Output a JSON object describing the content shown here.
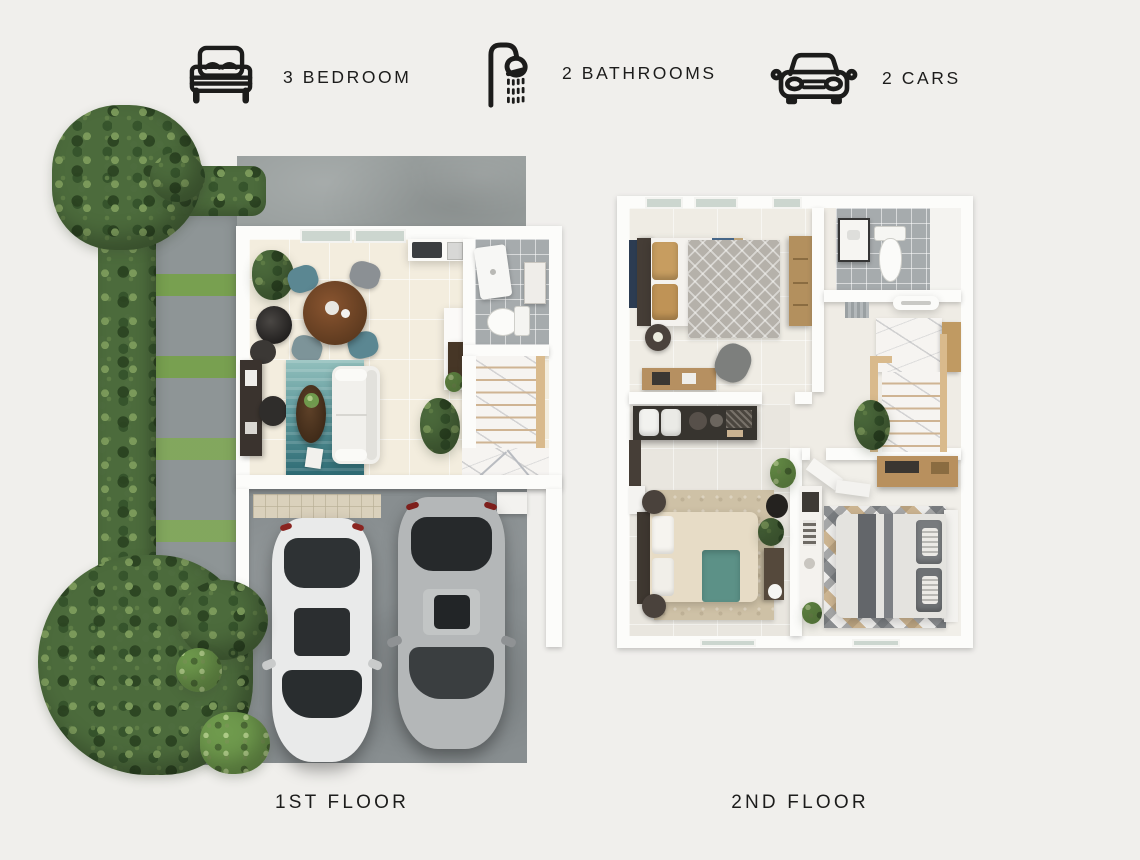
{
  "header": {
    "features": [
      {
        "icon": "bed-icon",
        "label": "3 BEDROOM"
      },
      {
        "icon": "shower-icon",
        "label": "2 BATHROOMS"
      },
      {
        "icon": "car-icon",
        "label": "2 CARS"
      }
    ]
  },
  "floors": {
    "first": {
      "label": "1ST FLOOR"
    },
    "second": {
      "label": "2ND FLOOR"
    }
  },
  "palette": {
    "background": "#f0efec",
    "text": "#1c1c1b",
    "wall_white": "#fcfcfa",
    "floor_beige": "#f3edde",
    "tile_gray": "#a6abad",
    "concrete_gray": "#9aa09f",
    "hedge_green": "#4c6b3c",
    "grass_green": "#78a050",
    "rug_teal": "#2d6a73",
    "dining_wood": "#6f4426",
    "marble_white": "#f6f4f1",
    "stair_wood": "#d9ba8c",
    "bed_runner_blue": "#47688a",
    "throw_teal": "#5c9187",
    "car_white": "#e9eaea",
    "car_gray": "#b4b7b8"
  }
}
